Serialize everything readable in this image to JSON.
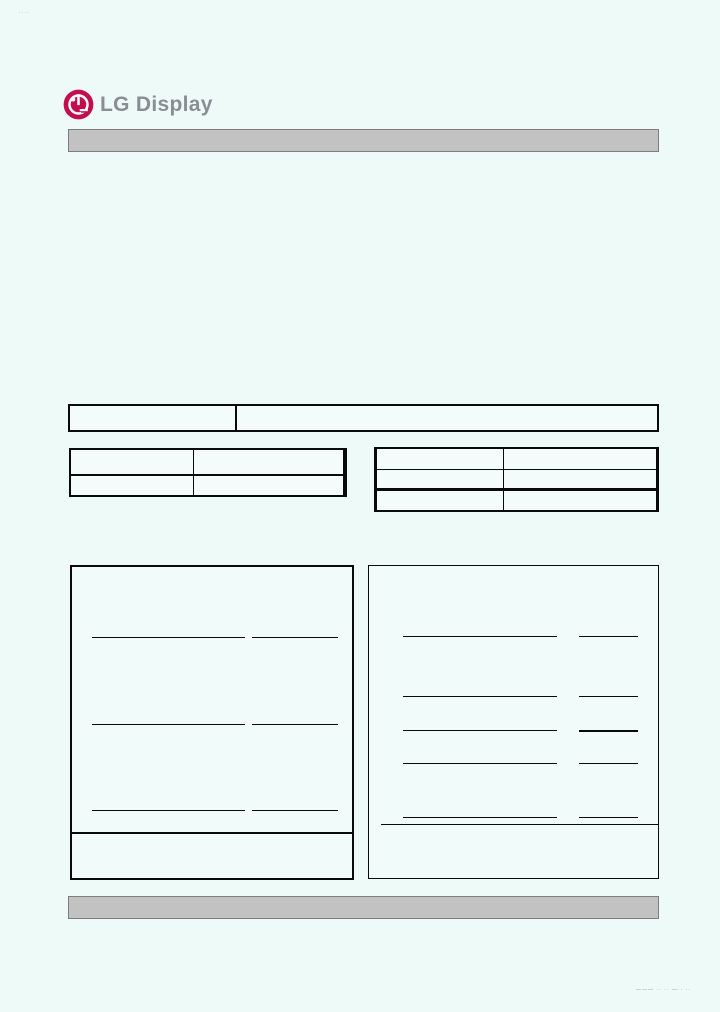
{
  "brand": {
    "logo_text": "LG Display",
    "logo_color": "#c30e4e",
    "logo_text_color": "#8a8e92"
  },
  "colors": {
    "page_background": "#eefaf8",
    "bar_fill": "#c2c2c2",
    "bar_border": "#7d7d7d",
    "table_line": "#0a0a0a"
  },
  "top_bar": {
    "text": ""
  },
  "bottom_bar": {
    "text": ""
  },
  "title_table": {
    "cells": [
      "",
      ""
    ]
  },
  "info_table_left": {
    "rows": [
      [
        "",
        ""
      ],
      [
        "",
        ""
      ]
    ]
  },
  "info_table_right": {
    "rows": [
      [
        "",
        ""
      ],
      [
        "",
        ""
      ],
      [
        "",
        ""
      ]
    ]
  },
  "approval_panel_left": {
    "signature_rows": [
      {
        "line": "",
        "date": ""
      },
      {
        "line": "",
        "date": ""
      },
      {
        "line": "",
        "date": ""
      }
    ],
    "footer_note": ""
  },
  "approval_panel_right": {
    "signature_rows": [
      {
        "line": "",
        "date": ""
      },
      {
        "line": "",
        "date": ""
      },
      {
        "line": "",
        "date": ""
      },
      {
        "line": "",
        "date": ""
      },
      {
        "line": "",
        "date": ""
      }
    ],
    "footer_note": ""
  },
  "watermarks": {
    "top_left": "····",
    "bottom_right": "―――  ··  ··  ―··  ··"
  }
}
